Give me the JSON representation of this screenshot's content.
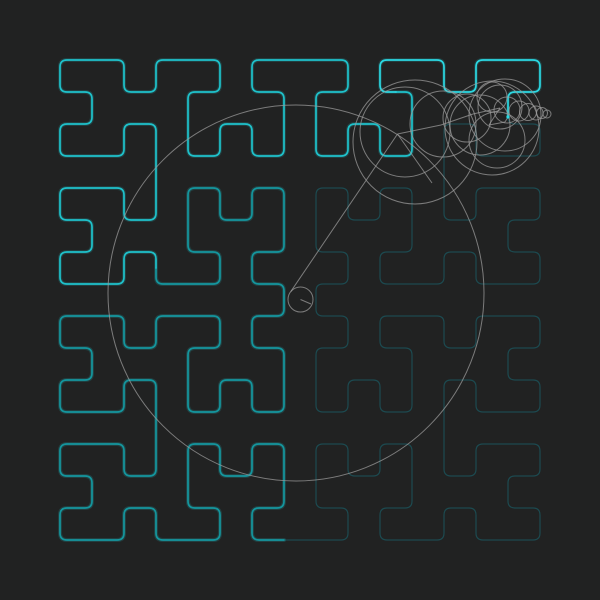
{
  "scene": {
    "width": 600,
    "height": 600,
    "background_color": "#212222"
  },
  "curve": {
    "type": "moore-closed-hilbert",
    "order": 4,
    "grid": 16,
    "margin": 60,
    "cell_size": 32,
    "corner_radius": 7,
    "faint_loop_color": "#1c4a50",
    "faint_loop_width": 1.2,
    "trail_width": 1.7,
    "trail_glow_opacity": 0.16,
    "trail_glow_width": 4,
    "trail_segments": [
      {
        "end_index": 80,
        "color": "#14969e"
      },
      {
        "end_index": 140,
        "color": "#1fc2cb"
      },
      {
        "end_index": -1,
        "color": "#2bd9e3"
      }
    ],
    "tip": {
      "x": 508,
      "y": 116,
      "cell_before_x": 508,
      "cell_before_y": 92,
      "cell_after_x": 508,
      "cell_after_y": 124
    }
  },
  "epicycles": {
    "stroke_color": "#9b9b9b",
    "stroke_width": 1,
    "stroke_opacity": 0.75,
    "big_circle": {
      "cx": 296,
      "cy": 293,
      "r": 188
    },
    "center_circle": {
      "cx": 300.5,
      "cy": 299.5,
      "r": 12.5
    },
    "circles": [
      {
        "cx": 405,
        "cy": 132,
        "r": 45
      },
      {
        "cx": 415,
        "cy": 142,
        "r": 62
      },
      {
        "cx": 443,
        "cy": 124,
        "r": 33
      },
      {
        "cx": 467,
        "cy": 118,
        "r": 24
      },
      {
        "cx": 480,
        "cy": 125,
        "r": 30
      },
      {
        "cx": 492,
        "cy": 128,
        "r": 47
      },
      {
        "cx": 497,
        "cy": 140,
        "r": 28
      },
      {
        "cx": 505,
        "cy": 115,
        "r": 36
      },
      {
        "cx": 492,
        "cy": 97,
        "r": 15
      },
      {
        "cx": 500,
        "cy": 107,
        "r": 22
      },
      {
        "cx": 507,
        "cy": 110,
        "r": 13
      },
      {
        "cx": 519,
        "cy": 111,
        "r": 10
      },
      {
        "cx": 528,
        "cy": 112,
        "r": 8.5
      },
      {
        "cx": 536,
        "cy": 113,
        "r": 7
      },
      {
        "cx": 542,
        "cy": 113,
        "r": 5.5
      },
      {
        "cx": 547,
        "cy": 114,
        "r": 4
      }
    ],
    "lines": [
      {
        "x1": 300.5,
        "y1": 299.5,
        "x2": 311,
        "y2": 304
      },
      {
        "x1": 290.7,
        "y1": 291.7,
        "x2": 397.5,
        "y2": 134
      },
      {
        "x1": 397.5,
        "y1": 134,
        "x2": 441,
        "y2": 125
      },
      {
        "x1": 397.5,
        "y1": 134,
        "x2": 432,
        "y2": 183
      },
      {
        "x1": 441,
        "y1": 125,
        "x2": 473,
        "y2": 114
      },
      {
        "x1": 473,
        "y1": 114,
        "x2": 500,
        "y2": 108
      },
      {
        "x1": 500,
        "y1": 108,
        "x2": 489,
        "y2": 125
      },
      {
        "x1": 489,
        "y1": 125,
        "x2": 505,
        "y2": 122
      },
      {
        "x1": 505,
        "y1": 122,
        "x2": 508,
        "y2": 117
      }
    ],
    "tip_dot": {
      "x": 508,
      "y": 117,
      "r": 1.6,
      "color": "#2bd9e3"
    }
  }
}
